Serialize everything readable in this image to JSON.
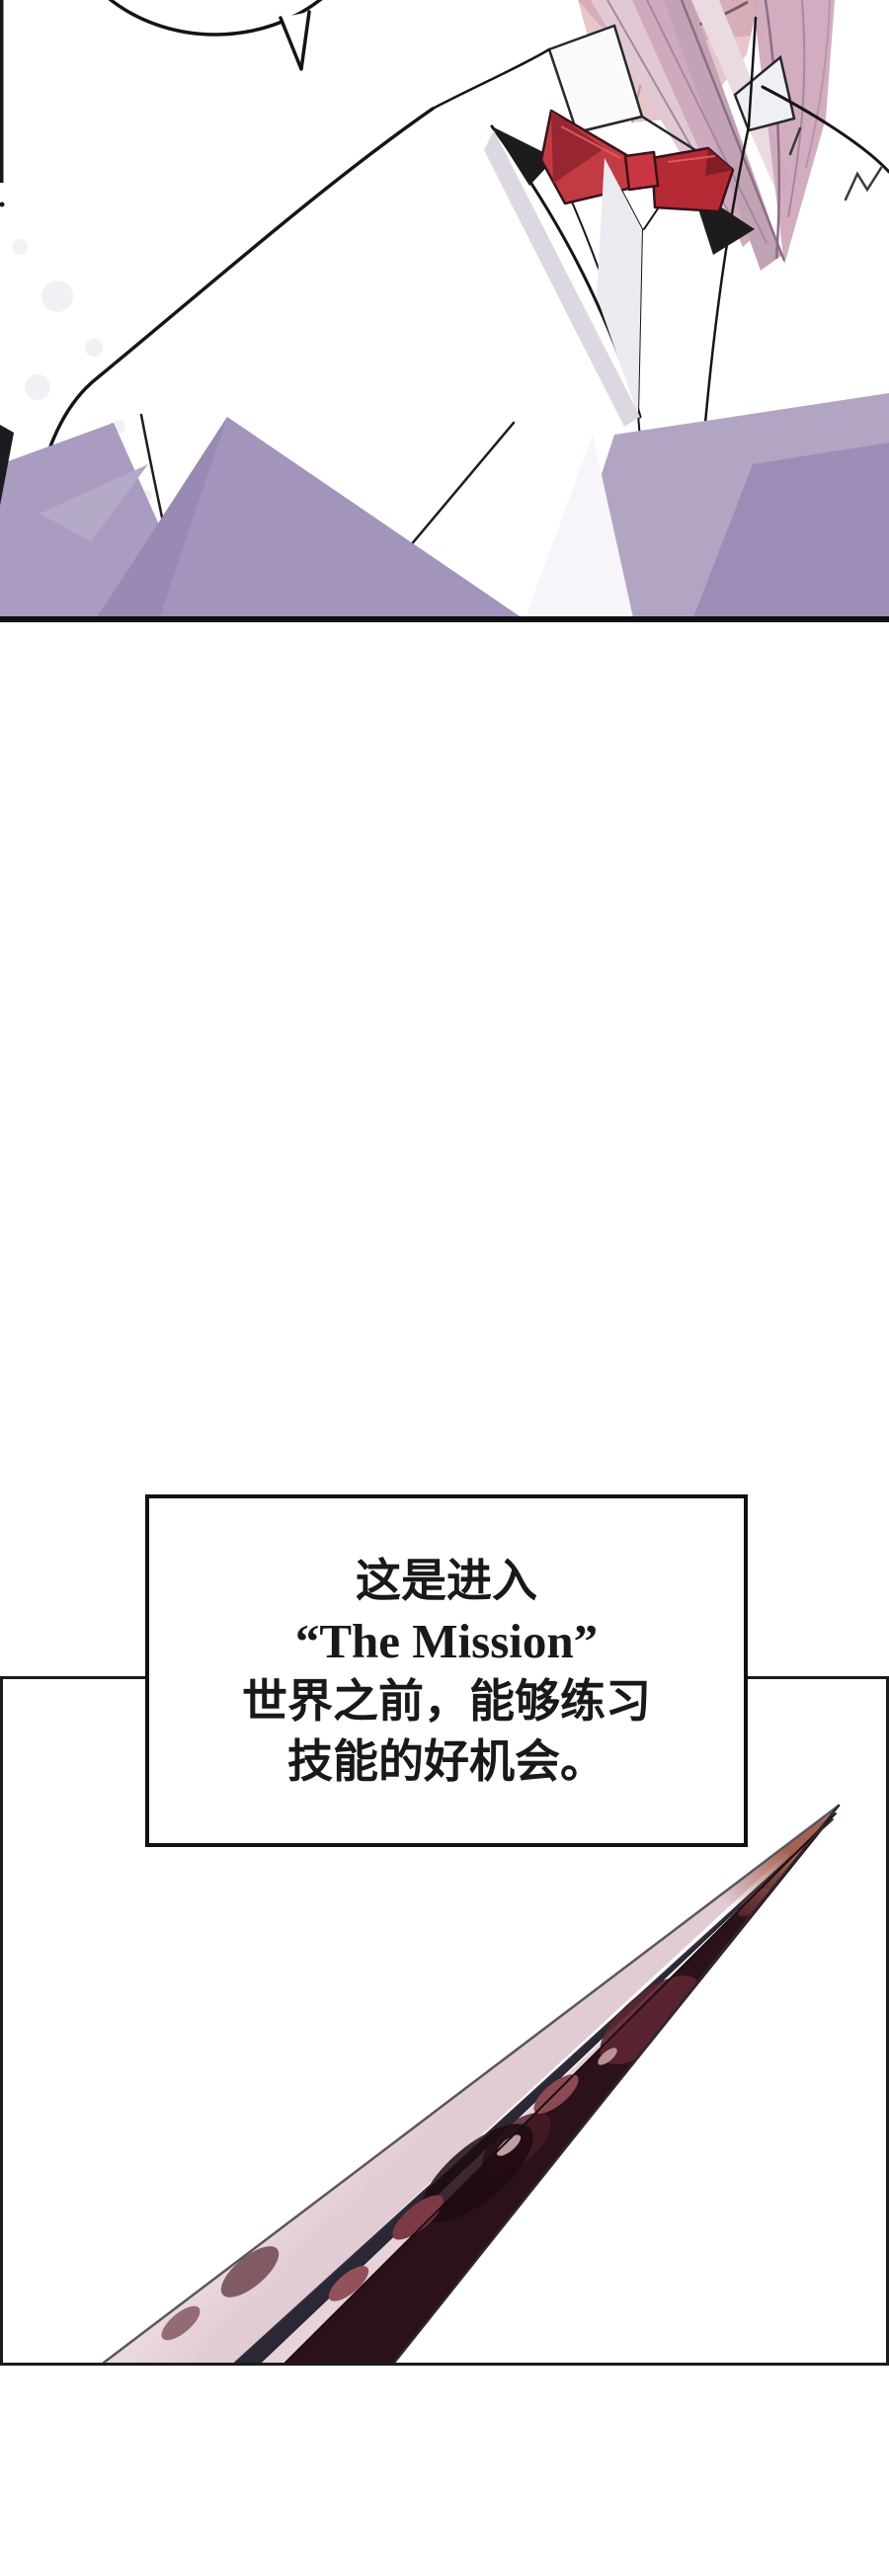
{
  "dialog_box": {
    "lines": [
      "这是进入",
      "“The Mission”",
      "世界之前，能够练习",
      "技能的好机会。"
    ]
  },
  "art": {
    "panel1": {
      "subject": "character-in-white-suit-with-red-bowtie",
      "bowtie_red": "#c23b43",
      "bowtie_shadow": "#8e1f2a",
      "hair_pink": "#cfa9bc",
      "skin_pink": "#e7c6c9",
      "suit_shadow_lavender": "#a99cc0",
      "line_color": "#161616"
    },
    "panel2": {
      "subject": "blood-stained-dagger-blade",
      "blade_face": "#efe4e7",
      "blade_fuller_dark": "#2c2734",
      "blade_blood_dark": "#2b1119",
      "blade_blood_light": "#8a4a52",
      "blade_tip_brown": "#a56250"
    },
    "panel_border": "#1a1a1a",
    "background": "#ffffff"
  }
}
